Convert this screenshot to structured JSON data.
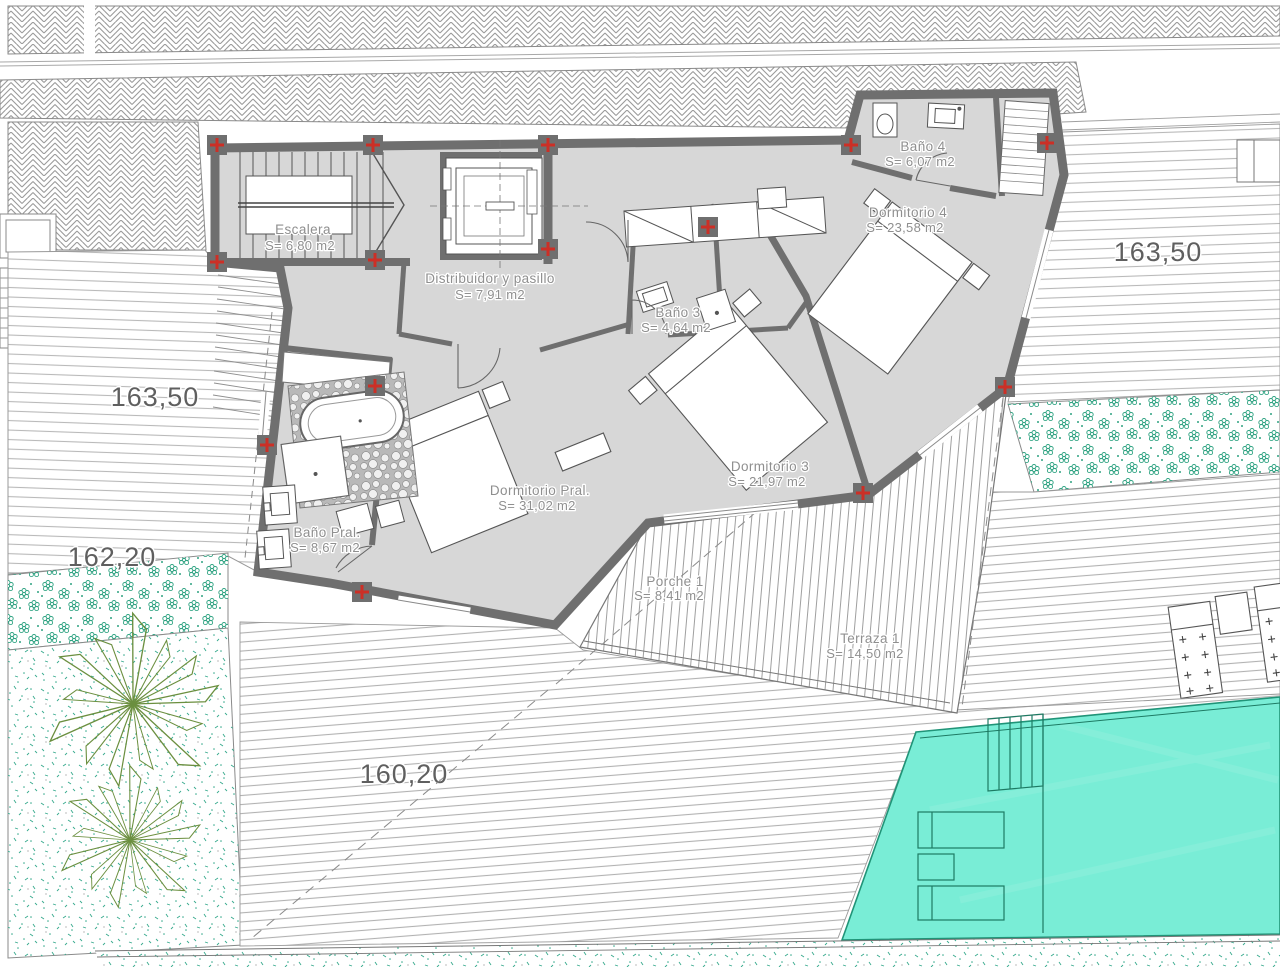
{
  "plan": {
    "rooms": {
      "escalera": {
        "name": "Escalera",
        "area": "S= 6,80 m2"
      },
      "distribuidor": {
        "name": "Distribuidor y pasillo",
        "area": "S= 7,91 m2"
      },
      "bano4": {
        "name": "Baño 4",
        "area": "S= 6,07 m2"
      },
      "dormitorio4": {
        "name": "Dormitorio 4",
        "area": "S= 23,58 m2"
      },
      "bano3": {
        "name": "Baño 3",
        "area": "S= 4,64 m2"
      },
      "dormitorio3": {
        "name": "Dormitorio 3",
        "area": "S= 21,97 m2"
      },
      "dormitorio_pral": {
        "name": "Dormitorio Pral.",
        "area": "S= 31,02 m2"
      },
      "bano_pral": {
        "name": "Baño Pral.",
        "area": "S= 8,67 m2"
      },
      "porche1": {
        "name": "Porche 1",
        "area": "S= 8,41 m2"
      },
      "terraza1": {
        "name": "Terraza 1",
        "area": "S= 14,50 m2"
      }
    },
    "elevations": {
      "upper_right": "163,50",
      "upper_left": "163,50",
      "mid_left": "162,20",
      "lower": "160,20"
    },
    "colors": {
      "wall": "#6f6f6f",
      "floor": "#d7d7d7",
      "pool": "#79edd6",
      "pool_line": "#1d7a63",
      "marker_red": "#cc2f26",
      "plant_green": "#6b8f3f",
      "shrub_teal": "#2fa382",
      "label_gray": "#8f8f8f"
    }
  }
}
